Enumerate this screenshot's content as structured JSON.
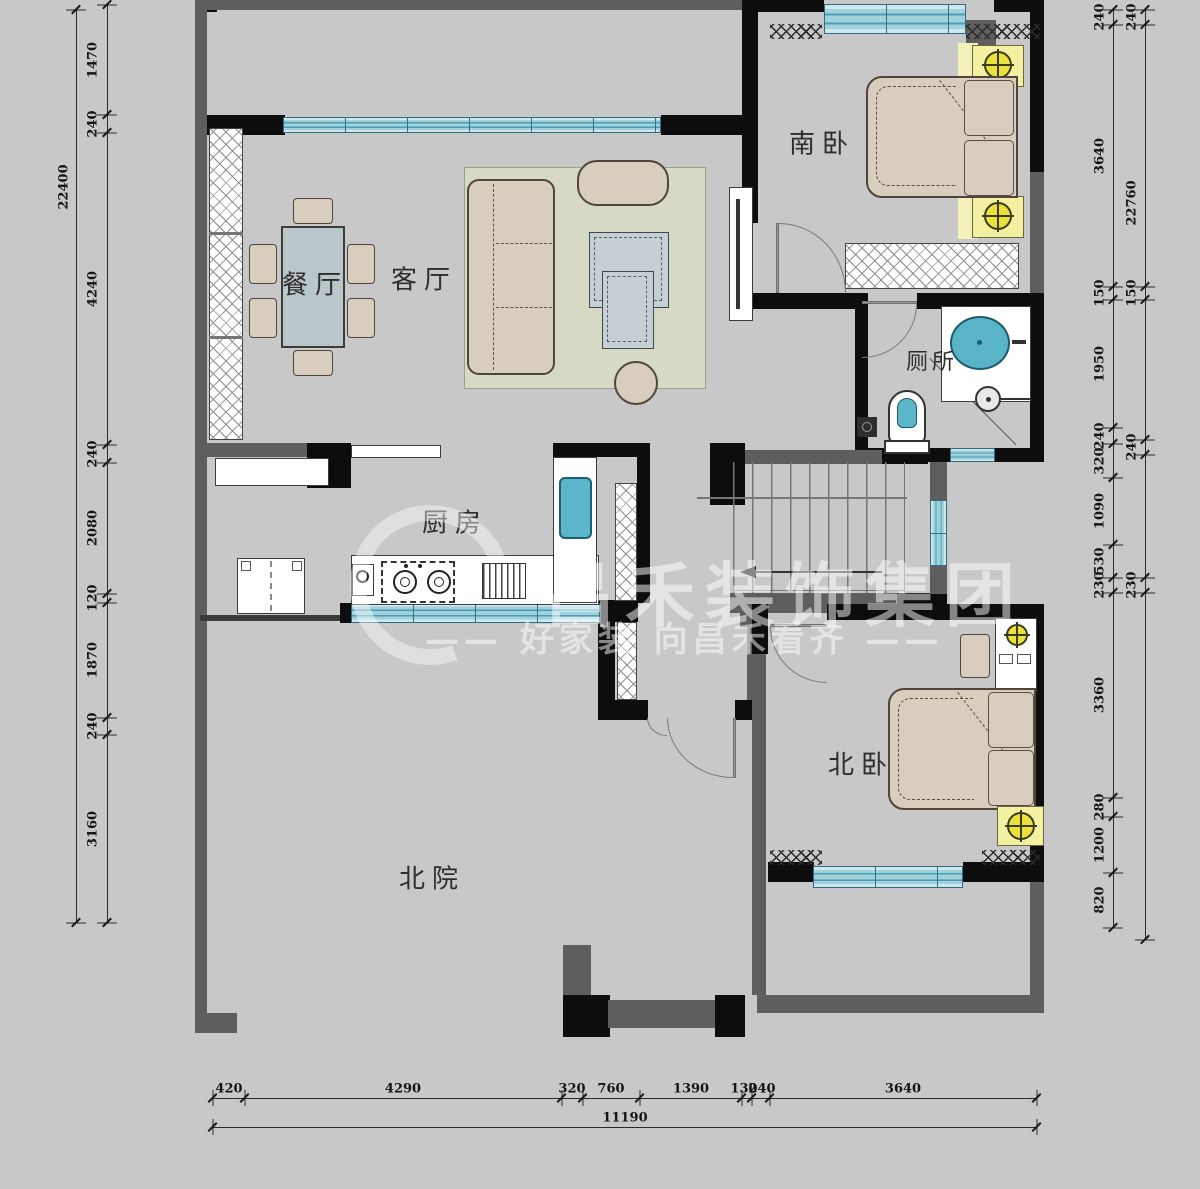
{
  "watermark": {
    "brand": "昌禾装饰集团",
    "tagline": "—— 好家装  向昌禾看齐 ——"
  },
  "rooms": {
    "south_bedroom": "南卧",
    "dining": "餐厅",
    "living": "客厅",
    "toilet": "厕所",
    "kitchen": "厨房",
    "north_bedroom": "北卧",
    "north_yard": "北院"
  },
  "dimensions": {
    "left_total": "22400",
    "left_top_partial": "3",
    "left_chain": [
      "1470",
      "240",
      "4240",
      "240",
      "2080",
      "120",
      "1870",
      "240",
      "3160"
    ],
    "right_chain": [
      "240",
      "3640",
      "150",
      "1950",
      "240",
      "320",
      "1090",
      "530",
      "230",
      "3360",
      "280",
      "1200",
      "820"
    ],
    "right_outer": [
      "240",
      "22760",
      "150",
      "240",
      "230"
    ],
    "bottom_chain": [
      "420",
      "4290",
      "320",
      "760",
      "1390",
      "130",
      "240",
      "3640"
    ],
    "bottom_total": "11190"
  },
  "colors": {
    "background": "#c8c8c8",
    "wall": "#0d0d0d",
    "wall_secondary": "#5e5e5e",
    "window": "#9fd2dc",
    "furniture": "#d9cdbe",
    "rug": "#d6d9c4",
    "accent_blue": "#5cb6ca",
    "accent_yellow": "#ece13a"
  }
}
